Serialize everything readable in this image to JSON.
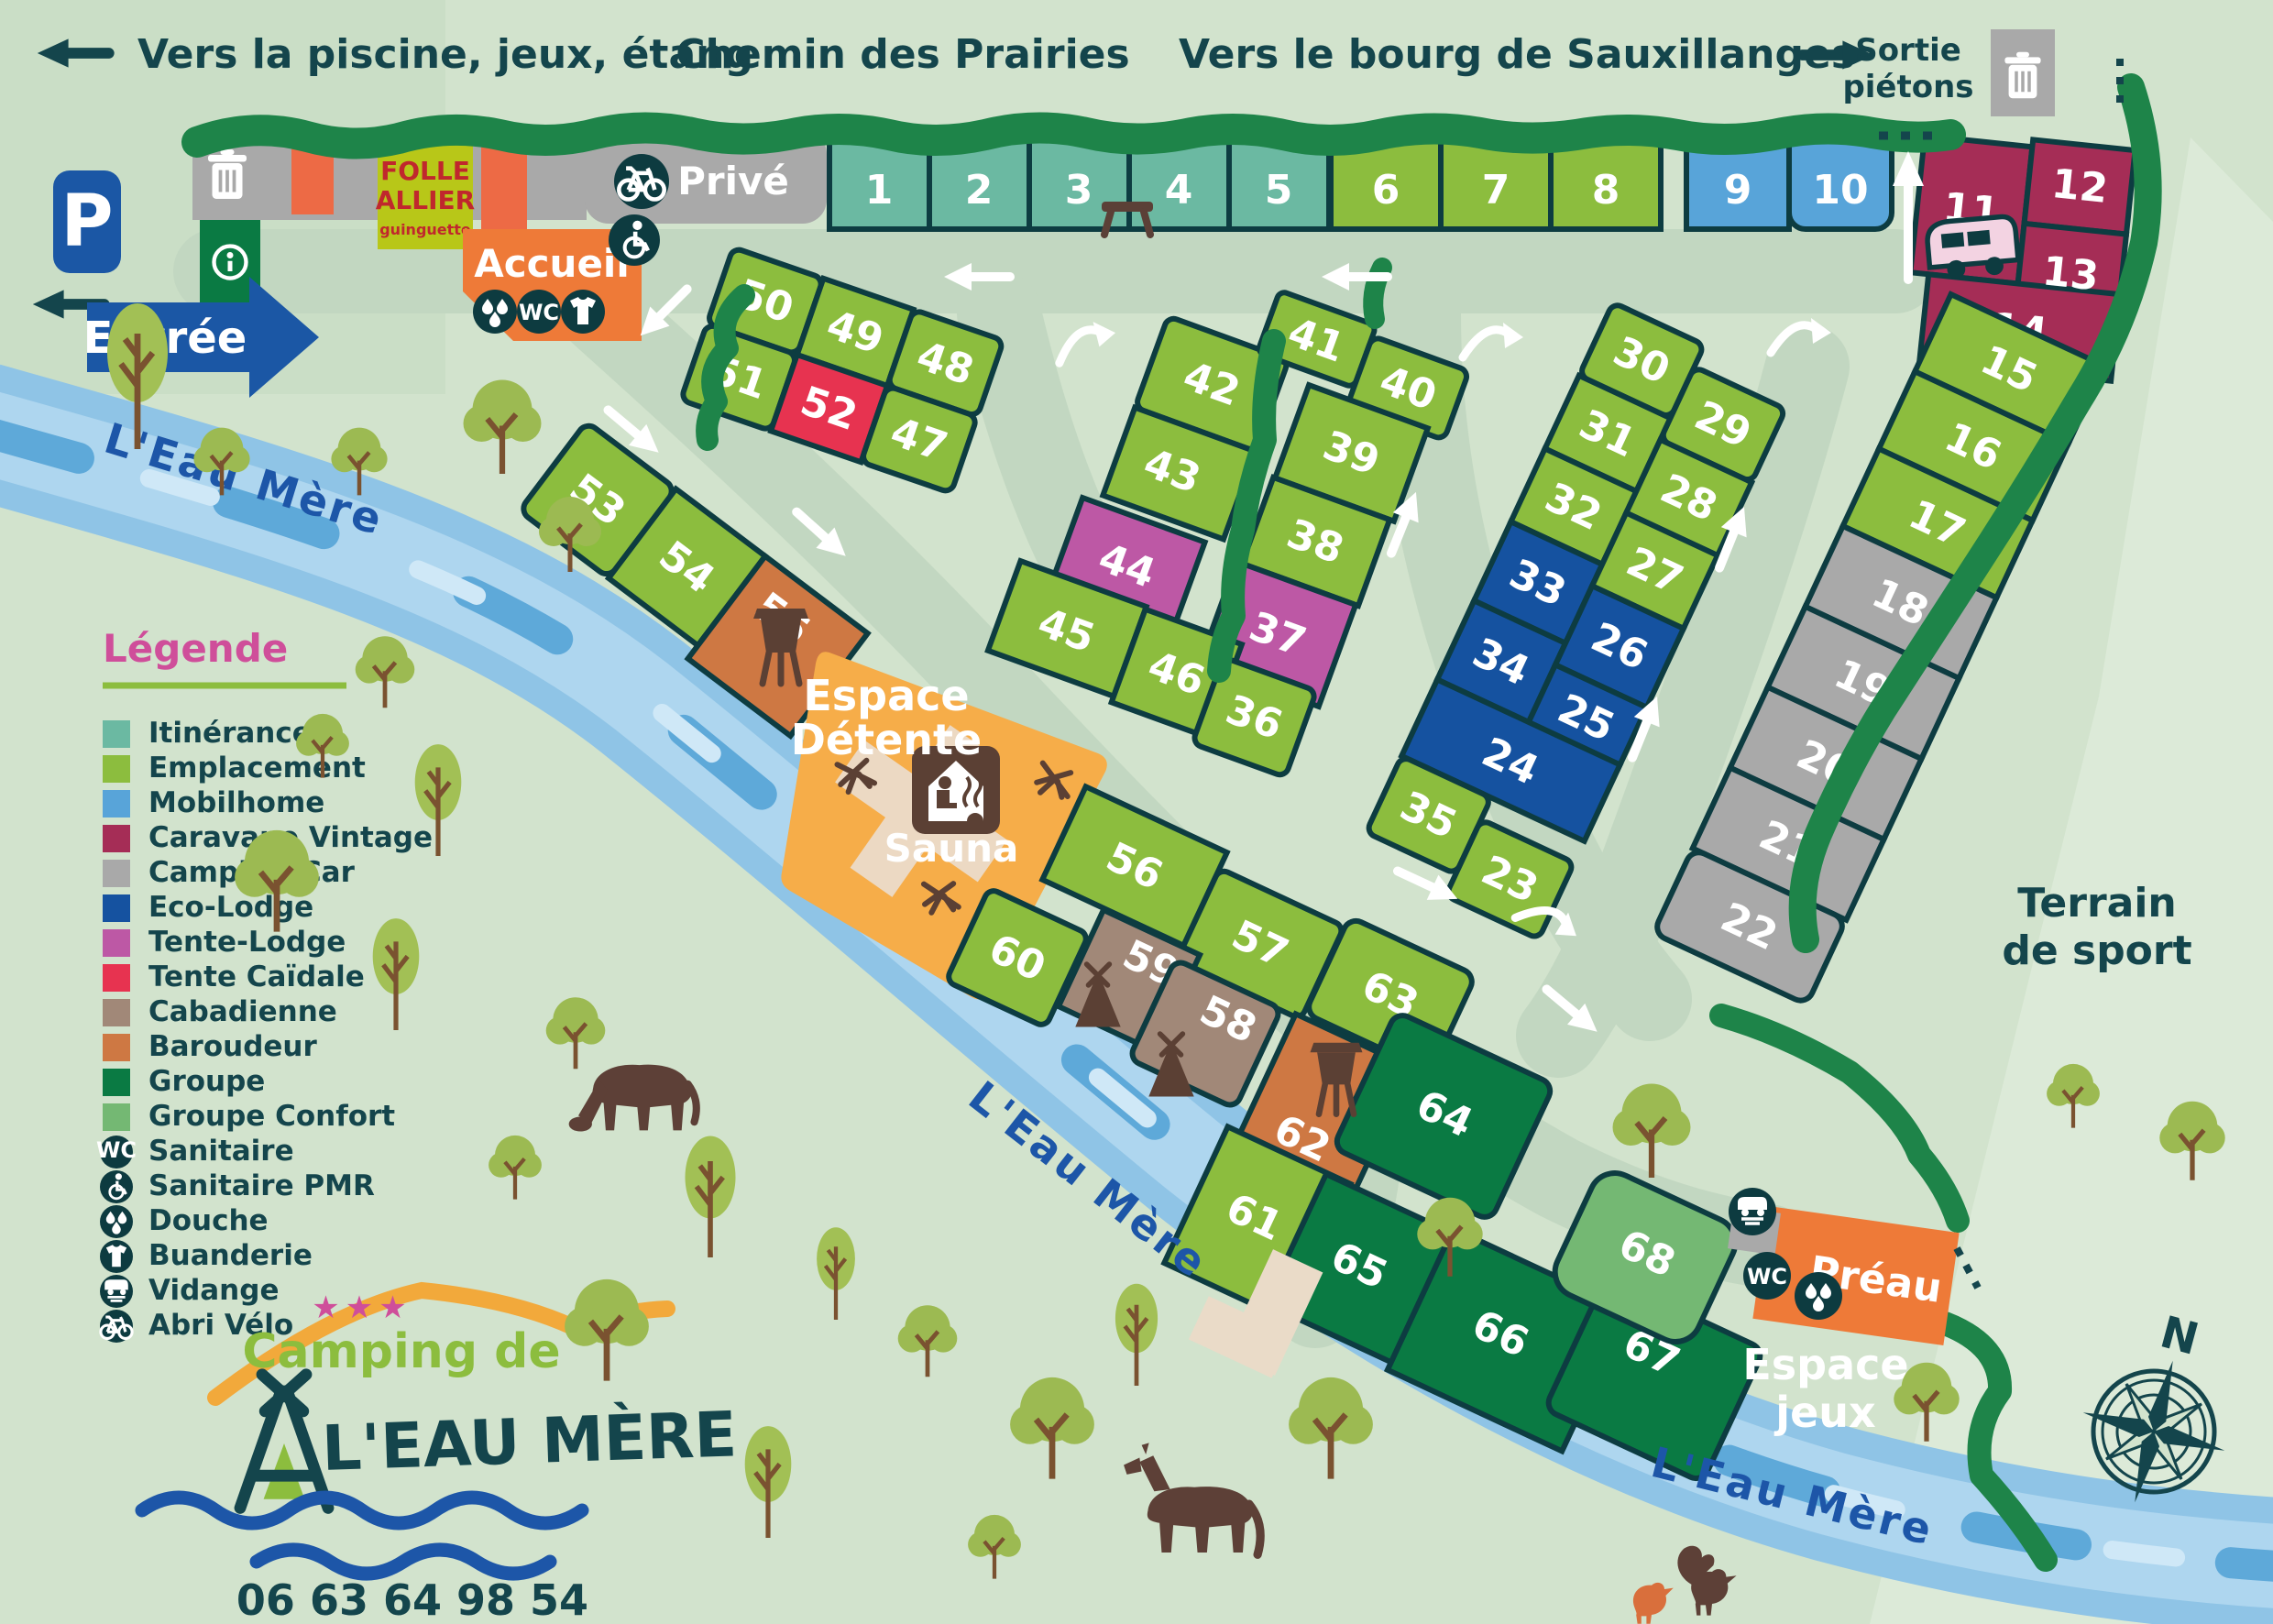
{
  "colors": {
    "accent_orange": "#EE7A38",
    "accent_blue": "#1B57A5",
    "river_blue": "#8FC4E6",
    "hedge_green": "#1E8449",
    "text_dark": "#14454C",
    "brand_pink": "#CF4E9A",
    "brand_green": "#8CBD3E"
  },
  "header": {
    "to_pool": "Vers la piscine, jeux, étang",
    "road": "Chemin des Prairies",
    "to_town": "Vers le bourg de Sauxillanges",
    "exit_line1": "Sortie",
    "exit_line2": "piétons"
  },
  "entrance": {
    "label": "Entrée",
    "parking": "P"
  },
  "buildings": {
    "reception": "Accueil",
    "private": "Privé",
    "guinguette_line1": "FOLLE",
    "guinguette_line2": "ALLIER",
    "guinguette_line3": "guinguette",
    "shelter": "Préau",
    "wc": "WC"
  },
  "areas": {
    "relax_line1": "Espace",
    "relax_line2": "Détente",
    "sauna": "Sauna",
    "sport_line1": "Terrain",
    "sport_line2": "de sport",
    "play_line1": "Espace",
    "play_line2": "jeux"
  },
  "river": {
    "name": "L'Eau Mère"
  },
  "legend": {
    "title": "Légende",
    "items": [
      {
        "label": "Itinérance",
        "color": "#6BB9A2"
      },
      {
        "label": "Emplacement",
        "color": "#8CBD3E"
      },
      {
        "label": "Mobilhome",
        "color": "#58A4D9"
      },
      {
        "label": "Caravane Vintage",
        "color": "#A52D56"
      },
      {
        "label": "Camping-Car",
        "color": "#A9A9A9"
      },
      {
        "label": "Eco-Lodge",
        "color": "#1552A0"
      },
      {
        "label": "Tente-Lodge",
        "color": "#BD58A5"
      },
      {
        "label": "Tente Caïdale",
        "color": "#E73350"
      },
      {
        "label": "Cabadienne",
        "color": "#A18878"
      },
      {
        "label": "Baroudeur",
        "color": "#CE7843"
      },
      {
        "label": "Groupe",
        "color": "#0A7A43"
      },
      {
        "label": "Groupe Confort",
        "color": "#74B873"
      }
    ],
    "icon_items": [
      {
        "label": "Sanitaire",
        "icon": "wc-icon"
      },
      {
        "label": "Sanitaire PMR",
        "icon": "wheelchair-icon"
      },
      {
        "label": "Douche",
        "icon": "shower-icon"
      },
      {
        "label": "Buanderie",
        "icon": "laundry-icon"
      },
      {
        "label": "Vidange",
        "icon": "drain-icon"
      },
      {
        "label": "Abri Vélo",
        "icon": "bike-icon"
      }
    ]
  },
  "logo": {
    "stars": "★★★",
    "line1": "Camping de",
    "line2": "L'EAU MÈRE",
    "phone": "06 63 64 98 54"
  },
  "compass": {
    "north": "N"
  },
  "plots": {
    "p1": "1",
    "p2": "2",
    "p3": "3",
    "p4": "4",
    "p5": "5",
    "p6": "6",
    "p7": "7",
    "p8": "8",
    "p9": "9",
    "p10": "10",
    "p11": "11",
    "p12": "12",
    "p13": "13",
    "p14": "14",
    "p15": "15",
    "p16": "16",
    "p17": "17",
    "p18": "18",
    "p19": "19",
    "p20": "20",
    "p21": "21",
    "p22": "22",
    "p23": "23",
    "p24": "24",
    "p25": "25",
    "p26": "26",
    "p27": "27",
    "p28": "28",
    "p29": "29",
    "p30": "30",
    "p31": "31",
    "p32": "32",
    "p33": "33",
    "p34": "34",
    "p35": "35",
    "p36": "36",
    "p37": "37",
    "p38": "38",
    "p39": "39",
    "p40": "40",
    "p41": "41",
    "p42": "42",
    "p43": "43",
    "p44": "44",
    "p45": "45",
    "p46": "46",
    "p47": "47",
    "p48": "48",
    "p49": "49",
    "p50": "50",
    "p51": "51",
    "p52": "52",
    "p53": "53",
    "p54": "54",
    "p55": "55",
    "p56": "56",
    "p57": "57",
    "p58": "58",
    "p59": "59",
    "p60": "60",
    "p61": "61",
    "p62": "62",
    "p63": "63",
    "p64": "64",
    "p65": "65",
    "p66": "66",
    "p67": "67",
    "p68": "68"
  }
}
